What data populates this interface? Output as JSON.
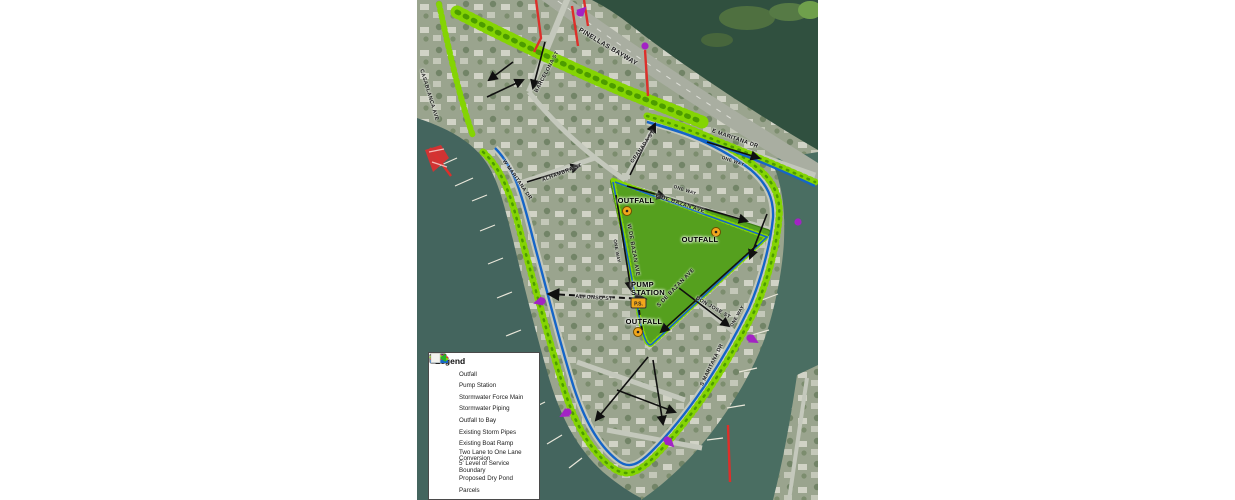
{
  "legend": {
    "title": "Legend",
    "items": [
      {
        "icon": "outfall-icon",
        "label": "Outfall"
      },
      {
        "icon": "pump-station-icon",
        "label": "Pump Station"
      },
      {
        "icon": "force-main-icon",
        "label": "Stormwater Force Main"
      },
      {
        "icon": "piping-icon",
        "label": "Stormwater Piping"
      },
      {
        "icon": "outfall-to-bay-icon",
        "label": "Outfall to Bay"
      },
      {
        "icon": "storm-pipes-icon",
        "label": "Existing Storm Pipes"
      },
      {
        "icon": "boat-ramp-icon",
        "label": "Existing Boat Ramp"
      },
      {
        "icon": "lane-conversion-icon",
        "label": "Two Lane to One Lane Conversion"
      },
      {
        "icon": "los-boundary-icon",
        "label": "5' Level of Service Boundary"
      },
      {
        "icon": "dry-pond-icon",
        "label": "Proposed Dry Pond"
      },
      {
        "icon": "parcels-icon",
        "label": "Parcels"
      }
    ]
  },
  "map": {
    "colors": {
      "pond_green": "#55a01e",
      "boundary_green": "#84d403",
      "boundary_green_dark": "#4c9b00",
      "lane_blue": "#1565c8",
      "pipe_red": "#dd2f2a",
      "outfall_purple": "#a323c4",
      "marker_orange": "#f2a71b"
    },
    "pump_station_abbrev": "P.S.",
    "street_labels": [
      {
        "text": "PINELLAS BAYWAY",
        "x": 191,
        "y": 47,
        "rot": 31,
        "size": 6.5
      },
      {
        "text": "E MARITANA DR",
        "x": 318,
        "y": 139,
        "rot": 19,
        "size": 5.5
      },
      {
        "text": "ONE WAY",
        "x": 316,
        "y": 161,
        "rot": 19,
        "size": 4.5
      },
      {
        "text": "BARCELONA ST",
        "x": 130,
        "y": 72,
        "rot": -62,
        "size": 5.2
      },
      {
        "text": "GRANADA ST",
        "x": 226,
        "y": 147,
        "rot": -55,
        "size": 5.2
      },
      {
        "text": "ALHAMBRA ST",
        "x": 145,
        "y": 173,
        "rot": -21,
        "size": 5.2
      },
      {
        "text": "W MARITANA DR",
        "x": 100,
        "y": 180,
        "rot": 55,
        "size": 5.2
      },
      {
        "text": "CASABLANCA AVE",
        "x": 12,
        "y": 95,
        "rot": 73,
        "size": 5.2
      },
      {
        "text": "E DE BAZAN AVE",
        "x": 263,
        "y": 204,
        "rot": 18,
        "size": 5.5
      },
      {
        "text": "ONE WAY",
        "x": 268,
        "y": 190,
        "rot": 18,
        "size": 4.5
      },
      {
        "text": "W DE BAZAN AVE",
        "x": 216,
        "y": 250,
        "rot": 80,
        "size": 5.5
      },
      {
        "text": "ONE WAY",
        "x": 200,
        "y": 251,
        "rot": 80,
        "size": 4.5
      },
      {
        "text": "S DE BAZAN AVE",
        "x": 259,
        "y": 288,
        "rot": -46,
        "size": 5.5
      },
      {
        "text": "ALFONSO ST",
        "x": 177,
        "y": 298,
        "rot": 4,
        "size": 5.2
      },
      {
        "text": "DON JOSE ST",
        "x": 296,
        "y": 308,
        "rot": 30,
        "size": 5.2
      },
      {
        "text": "S MARITANA DR",
        "x": 295,
        "y": 365,
        "rot": -64,
        "size": 5.2
      },
      {
        "text": "ONE WAY",
        "x": 320,
        "y": 316,
        "rot": -60,
        "size": 4.5
      }
    ],
    "callouts": [
      {
        "text": "OUTFALL",
        "x": 219,
        "y": 201
      },
      {
        "text": "OUTFALL",
        "x": 283,
        "y": 240
      },
      {
        "text": "OUTFALL",
        "x": 227,
        "y": 322
      },
      {
        "text": "PUMP\nSTATION",
        "x": 231,
        "y": 289
      }
    ]
  }
}
